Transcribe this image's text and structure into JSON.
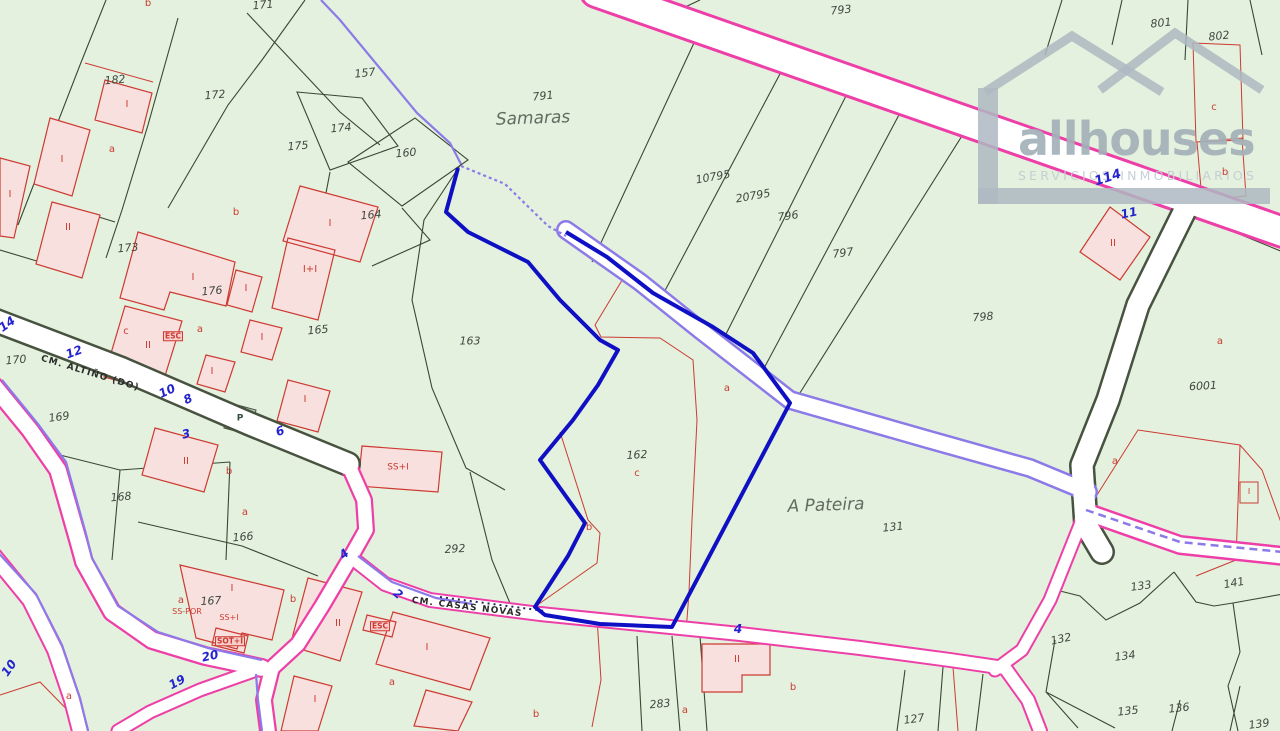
{
  "logo": {
    "title": "allhouses",
    "subtitle": "SERVICIOS INMOBILIARIOS"
  },
  "colors": {
    "background": "#e3f1de",
    "road-fill": "#ffffff",
    "road-magenta": "#ee3fa8",
    "road-edge": "#47523f",
    "violet": "#8b7ae8",
    "parcel-line": "#3a4733",
    "red-line": "#cd3a32",
    "building-fill": "#f8e0de",
    "highlight-blue": "#0f10c3",
    "street-number": "#2424cf",
    "parcel-text": "#3f463f",
    "place-text": "#626c62",
    "red-text": "#cd3a32",
    "logo-gray": "#aeb9c2",
    "logo-text": "#a3b1ba",
    "logo-sub": "#c4cdd3"
  },
  "map": {
    "labels": {
      "parcels": [
        {
          "t": "182",
          "x": 115,
          "y": 80,
          "r": -5
        },
        {
          "t": "171",
          "x": 263,
          "y": 5,
          "r": -5
        },
        {
          "t": "172",
          "x": 215,
          "y": 95,
          "r": -5
        },
        {
          "t": "157",
          "x": 365,
          "y": 73,
          "r": -6
        },
        {
          "t": "174",
          "x": 341,
          "y": 128,
          "r": -5
        },
        {
          "t": "175",
          "x": 298,
          "y": 146,
          "r": -5
        },
        {
          "t": "160",
          "x": 406,
          "y": 153,
          "r": -5
        },
        {
          "t": "164",
          "x": 371,
          "y": 215,
          "r": -5
        },
        {
          "t": "173",
          "x": 128,
          "y": 248,
          "r": -5
        },
        {
          "t": "176",
          "x": 212,
          "y": 291,
          "r": -5
        },
        {
          "t": "165",
          "x": 318,
          "y": 330,
          "r": -5
        },
        {
          "t": "170",
          "x": 16,
          "y": 360,
          "r": -5
        },
        {
          "t": "163",
          "x": 470,
          "y": 341
        },
        {
          "t": "169",
          "x": 59,
          "y": 417,
          "r": -8
        },
        {
          "t": "168",
          "x": 121,
          "y": 497,
          "r": -5
        },
        {
          "t": "166",
          "x": 243,
          "y": 537,
          "r": -5
        },
        {
          "t": "167",
          "x": 211,
          "y": 601,
          "r": -3
        },
        {
          "t": "292",
          "x": 455,
          "y": 549,
          "r": -3
        },
        {
          "t": "162",
          "x": 637,
          "y": 455,
          "r": -3
        },
        {
          "t": "131",
          "x": 893,
          "y": 527,
          "r": -6
        },
        {
          "t": "791",
          "x": 543,
          "y": 96,
          "r": -6
        },
        {
          "t": "793",
          "x": 841,
          "y": 10,
          "r": -6
        },
        {
          "t": "10795",
          "x": 713,
          "y": 177,
          "r": -10
        },
        {
          "t": "20795",
          "x": 753,
          "y": 196,
          "r": -10
        },
        {
          "t": "796",
          "x": 788,
          "y": 216,
          "r": -8
        },
        {
          "t": "797",
          "x": 843,
          "y": 253,
          "r": -8
        },
        {
          "t": "798",
          "x": 983,
          "y": 317,
          "r": -5
        },
        {
          "t": "801",
          "x": 1161,
          "y": 23,
          "r": -6
        },
        {
          "t": "802",
          "x": 1219,
          "y": 36,
          "r": -6
        },
        {
          "t": "6001",
          "x": 1203,
          "y": 386,
          "r": -3
        },
        {
          "t": "283",
          "x": 660,
          "y": 704,
          "r": -5
        },
        {
          "t": "127",
          "x": 914,
          "y": 719,
          "r": -8
        },
        {
          "t": "133",
          "x": 1141,
          "y": 586,
          "r": -8
        },
        {
          "t": "141",
          "x": 1234,
          "y": 583,
          "r": -10
        },
        {
          "t": "132",
          "x": 1061,
          "y": 639,
          "r": -12
        },
        {
          "t": "134",
          "x": 1125,
          "y": 656,
          "r": -8
        },
        {
          "t": "135",
          "x": 1128,
          "y": 711,
          "r": -6
        },
        {
          "t": "136",
          "x": 1179,
          "y": 708,
          "r": -6
        },
        {
          "t": "139",
          "x": 1259,
          "y": 724,
          "r": -8
        }
      ],
      "places": [
        {
          "t": "Samaras",
          "x": 533,
          "y": 119,
          "r": -2
        },
        {
          "t": "A Pateira",
          "x": 826,
          "y": 506,
          "r": -2
        }
      ],
      "streets": [
        {
          "t": "14",
          "x": 7,
          "y": 324,
          "r": -35
        },
        {
          "t": "12",
          "x": 74,
          "y": 352,
          "r": -20
        },
        {
          "t": "10",
          "x": 167,
          "y": 391,
          "r": -25
        },
        {
          "t": "8",
          "x": 188,
          "y": 399,
          "r": -25
        },
        {
          "t": "6",
          "x": 280,
          "y": 431,
          "r": -20
        },
        {
          "t": "3",
          "x": 186,
          "y": 434,
          "r": -12
        },
        {
          "t": "4",
          "x": 344,
          "y": 554,
          "r": -40
        },
        {
          "t": "2",
          "x": 398,
          "y": 594,
          "r": 40
        },
        {
          "t": "20",
          "x": 210,
          "y": 656,
          "r": -12
        },
        {
          "t": "19",
          "x": 177,
          "y": 682,
          "r": -28
        },
        {
          "t": "10",
          "x": 9,
          "y": 668,
          "r": -55
        },
        {
          "t": "4",
          "x": 738,
          "y": 629
        },
        {
          "t": "114",
          "x": 1108,
          "y": 178,
          "r": -18,
          "s": 13
        },
        {
          "t": "11",
          "x": 1129,
          "y": 213,
          "r": -12
        }
      ],
      "buildings": [
        {
          "t": "I",
          "x": 127,
          "y": 105
        },
        {
          "t": "I",
          "x": 62,
          "y": 160
        },
        {
          "t": "I",
          "x": 10,
          "y": 195
        },
        {
          "t": "II",
          "x": 68,
          "y": 228
        },
        {
          "t": "I",
          "x": 193,
          "y": 278
        },
        {
          "t": "II",
          "x": 148,
          "y": 346
        },
        {
          "t": "I",
          "x": 246,
          "y": 289
        },
        {
          "t": "I+I",
          "x": 310,
          "y": 270
        },
        {
          "t": "I",
          "x": 262,
          "y": 338
        },
        {
          "t": "I",
          "x": 212,
          "y": 372
        },
        {
          "t": "I",
          "x": 330,
          "y": 224
        },
        {
          "t": "I",
          "x": 305,
          "y": 400
        },
        {
          "t": "II",
          "x": 186,
          "y": 462
        },
        {
          "t": "SS+I",
          "x": 398,
          "y": 468,
          "s": 9
        },
        {
          "t": "I",
          "x": 232,
          "y": 589
        },
        {
          "t": "II",
          "x": 338,
          "y": 624
        },
        {
          "t": "I",
          "x": 427,
          "y": 648
        },
        {
          "t": "I",
          "x": 315,
          "y": 700
        },
        {
          "t": "II",
          "x": 737,
          "y": 660
        },
        {
          "t": "II",
          "x": 1113,
          "y": 244
        },
        {
          "t": "I",
          "x": 1249,
          "y": 492,
          "s": 8
        }
      ],
      "reds": [
        {
          "t": "a",
          "x": 112,
          "y": 150
        },
        {
          "t": "b",
          "x": 148,
          "y": 4
        },
        {
          "t": "b",
          "x": 236,
          "y": 213
        },
        {
          "t": "c",
          "x": 126,
          "y": 332
        },
        {
          "t": "a",
          "x": 200,
          "y": 330
        },
        {
          "t": "a",
          "x": 727,
          "y": 389
        },
        {
          "t": "c",
          "x": 637,
          "y": 474
        },
        {
          "t": "b",
          "x": 589,
          "y": 528
        },
        {
          "t": "b",
          "x": 229,
          "y": 472
        },
        {
          "t": "a",
          "x": 245,
          "y": 513
        },
        {
          "t": "a",
          "x": 181,
          "y": 601
        },
        {
          "t": "b",
          "x": 293,
          "y": 600
        },
        {
          "t": "SS-POR",
          "x": 187,
          "y": 612,
          "s": 8
        },
        {
          "t": "SS+I",
          "x": 229,
          "y": 618,
          "s": 8
        },
        {
          "t": "a",
          "x": 392,
          "y": 683
        },
        {
          "t": "a",
          "x": 69,
          "y": 697
        },
        {
          "t": "b",
          "x": 536,
          "y": 715
        },
        {
          "t": "a",
          "x": 685,
          "y": 711
        },
        {
          "t": "b",
          "x": 793,
          "y": 688
        },
        {
          "t": "c",
          "x": 1214,
          "y": 108
        },
        {
          "t": "b",
          "x": 1225,
          "y": 173
        },
        {
          "t": "a",
          "x": 1220,
          "y": 342
        },
        {
          "t": "a",
          "x": 1115,
          "y": 462
        }
      ],
      "boxes": [
        {
          "t": "ESC",
          "x": 173,
          "y": 336
        },
        {
          "t": "ESC",
          "x": 380,
          "y": 626
        },
        {
          "t": "SOT+I",
          "x": 230,
          "y": 641
        }
      ],
      "roadnames": [
        {
          "t": "CM. ALTIÑO (DO)",
          "x": 90,
          "y": 374,
          "r": 17
        },
        {
          "t": "CM. CASAS NOVAS",
          "x": 467,
          "y": 608,
          "r": 7
        }
      ],
      "special": [
        {
          "t": "P",
          "x": 240,
          "y": 419
        }
      ]
    }
  }
}
